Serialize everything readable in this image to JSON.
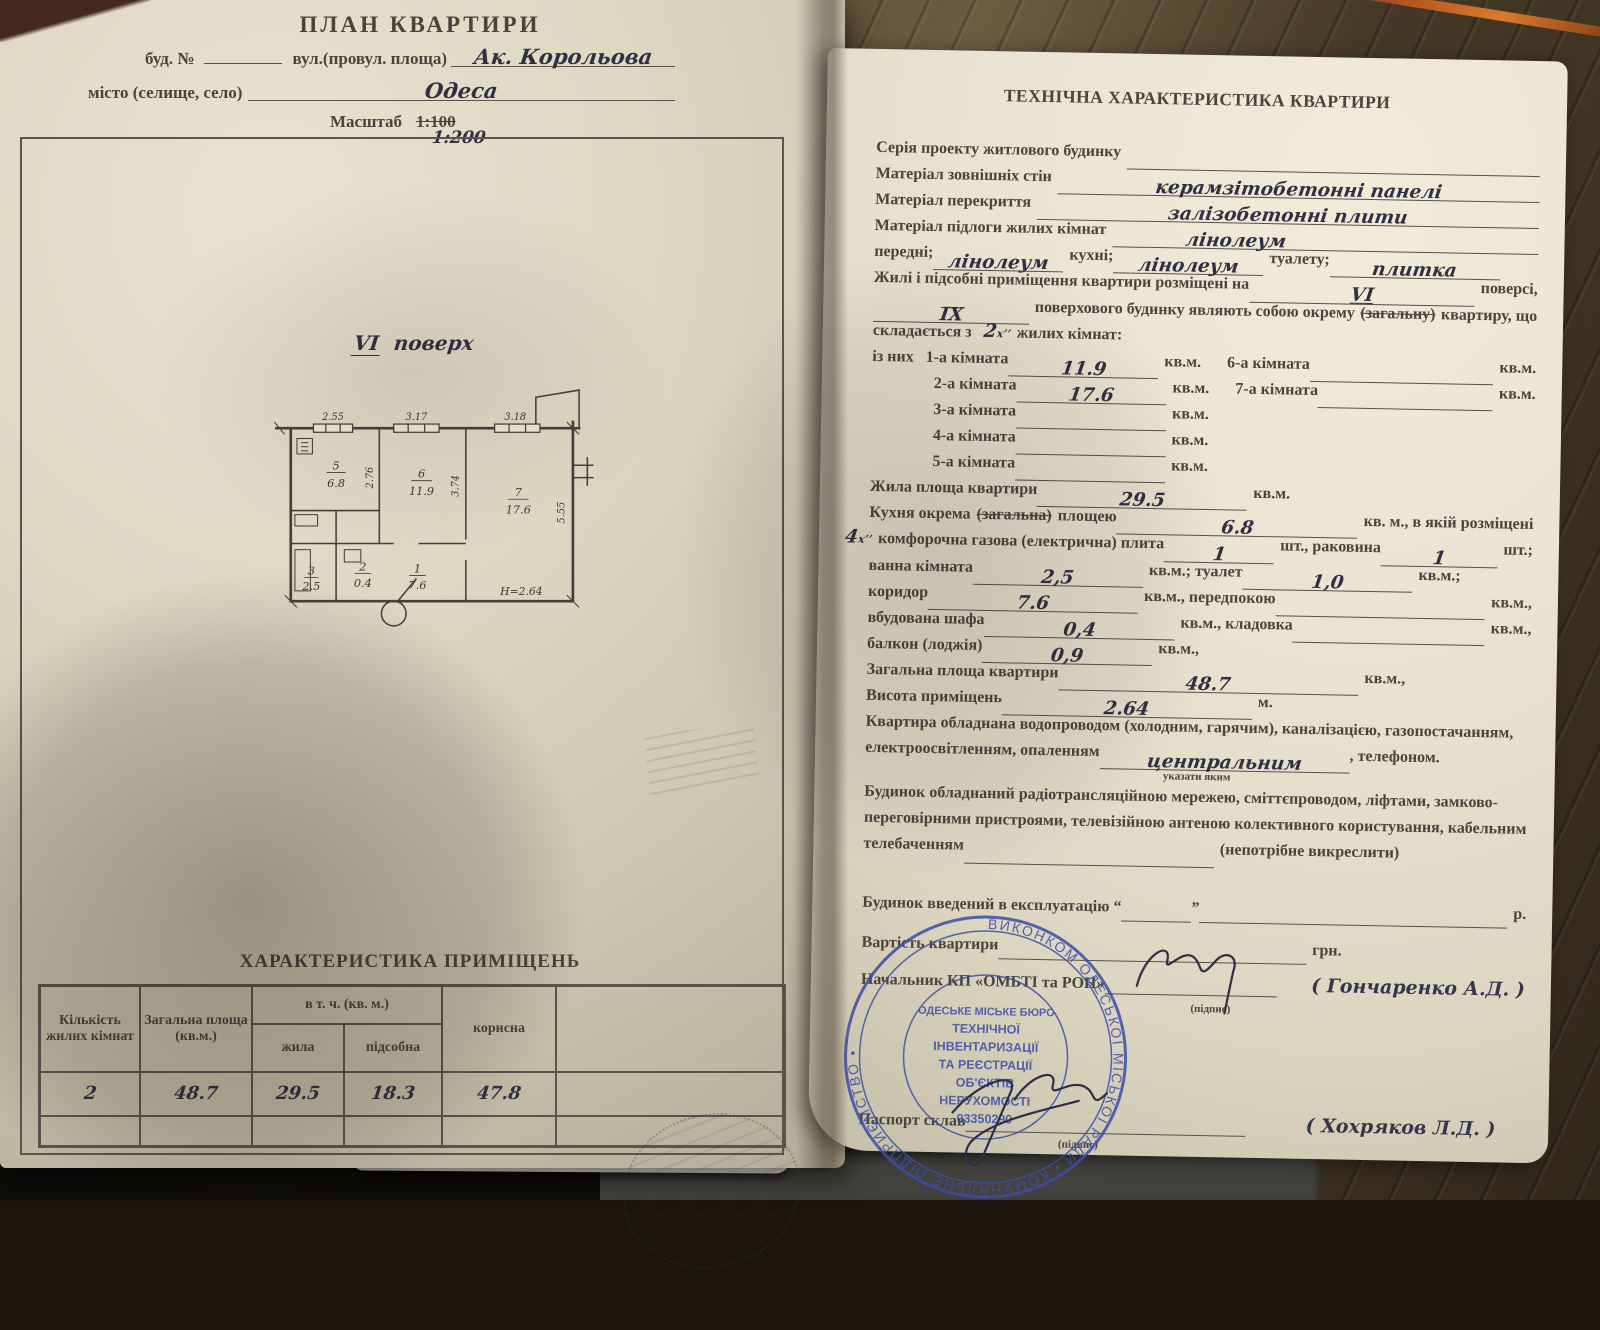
{
  "left": {
    "title": "ПЛАН  КВАРТИРИ",
    "f1a": "буд.  №",
    "f1b": "вул.(провул. площа)",
    "street": "Ак.  Корольова",
    "f2a": "місто (селище, село)",
    "city": "Одеса",
    "f3a": "Масштаб",
    "scale_old": "1:100",
    "scale_new": "1:200",
    "floor_vi": "VI",
    "floor_word": "поверх",
    "plan": {
      "d_top1": "2.55",
      "d_top2": "3.17",
      "d_top3": "3.18",
      "d_k": "2.76",
      "d_6": "3.74",
      "d_7": "5.55",
      "r5n": "5",
      "r5a": "6.8",
      "r6n": "6",
      "r6a": "11.9",
      "r7n": "7",
      "r7a": "17.6",
      "r2n": "2",
      "r2a": "0.4",
      "r1n": "1",
      "r1a": "7.6",
      "r3n": "3",
      "r3a": "2.5",
      "h": "Н=2.64"
    },
    "table": {
      "title": "ХАРАКТЕРИСТИКА ПРИМІЩЕНЬ",
      "h1": "Кількість жилих кімнат",
      "h2": "Загальна площа (кв.м.)",
      "h3": "в т. ч. (кв. м.)",
      "h3a": "жила",
      "h3b": "підсобна",
      "h4": "корисна",
      "row": [
        "2",
        "48.7",
        "29.5",
        "18.3",
        "47.8"
      ]
    }
  },
  "right": {
    "title": "ТЕХНІЧНА ХАРАКТЕРИСТИКА КВАРТИРИ",
    "l01a": "Серія проекту житлового будинку",
    "l02a": "Матеріал зовнішніх стін",
    "l02v": "керамзітобетонні  панелі",
    "l03a": "Матеріал перекриття",
    "l03v": "залізобетонні   плити",
    "l04a": "Матеріал підлоги жилих кімнат",
    "l04v": "лінолеум",
    "l05a": "передні;",
    "l05v1": "лінолеум",
    "l05b": "кухні;",
    "l05v2": "лінолеум",
    "l05c": "туалету;",
    "l05v3": "плитка",
    "l06a": "Жилі і підсобні приміщення квартири розміщені на",
    "l06v": "VI",
    "l06b": "поверсі,",
    "l07v": "ІХ",
    "l07a": "поверхового будинку являють собою окрему",
    "l07s": "(загальну)",
    "l07b": "квартиру, що",
    "l08a": "складається з",
    "l08v": "2",
    "l08sup": "х’’",
    "l08b": "жилих кімнат:",
    "l09a": "із них",
    "l09b": "1-а кімната",
    "l09v": "11.9",
    "l09c": "кв.м.",
    "l09d": "6-а кімната",
    "l09e": "кв.м.",
    "l10a": "2-а кімната",
    "l10v": "17.6",
    "l10b": "кв.м.",
    "l10c": "7-а кімната",
    "l10d": "кв.м.",
    "l11a": "3-а кімната",
    "l11b": "кв.м.",
    "l12a": "4-а кімната",
    "l12b": "кв.м.",
    "l13a": "5-а кімната",
    "l13b": "кв.м.",
    "l14a": "Жила площа квартири",
    "l14v": "29.5",
    "l14b": "кв.м.",
    "l15a": "Кухня окрема",
    "l15s": "(загальна)",
    "l15b": "площею",
    "l15v": "6.8",
    "l15c": "кв. м., в якій розміщені",
    "l16v0": "4",
    "l16sup": "х’’",
    "l16a": "комфорочна  газова  (електрична)  плита",
    "l16v1": "1",
    "l16b": "шт., раковина",
    "l16v2": "1",
    "l16c": "шт.;",
    "l17a": "ванна кімната",
    "l17v": "2,5",
    "l17b": "кв.м.; туалет",
    "l17v2": "1,0",
    "l17c": "кв.м.;",
    "l18a": "коридор",
    "l18v": "7.6",
    "l18b": "кв.м., передпокою",
    "l18c": "кв.м.,",
    "l19a": "вбудована шафа",
    "l19v": "0,4",
    "l19b": "кв.м., кладовка",
    "l19c": "кв.м.,",
    "l20a": "балкон (лоджія)",
    "l20v": "0,9",
    "l20b": "кв.м.,",
    "l21a": "Загальна площа квартири",
    "l21v": "48.7",
    "l21b": "кв.м.,",
    "l22a": "Висота приміщень",
    "l22v": "2.64",
    "l22b": "м.",
    "l23a": "Квартира обладнана водопроводом  (холодним, гарячим),  каналізацією,  газопостачанням,",
    "l24a": "електроосвітленням, опаленням",
    "l24v": "центральним",
    "l24b": ", телефоном.",
    "l25a": "указати яким",
    "l26a": "Будинок  обладнаний   радіотрансляційною  мережею,  сміттєпроводом,  ліфтами,  замково-",
    "l27a": "переговірними пристроями,  телевізійною антеною  колективного  користування,  кабельним",
    "l28a": "телебаченням",
    "l28b": "(непотрібне викреслити)",
    "l29a": "Будинок  введений   в експлуатацію “",
    "l29q": "”",
    "l29b": "р.",
    "l30b": "грн.",
    "l30a": "Вартість квартири",
    "l31a": "Начальник КП «ОМБТІ та РОН»",
    "l31sub": "(підпис)",
    "l31name": "(  Гончаренко  А.Д. )",
    "l32a": "Паспорт склав",
    "l32sub": "(підпис)",
    "l32name": "(  Хохряков  Л.Д. )",
    "stamp": {
      "ring": "ВИКОНКОМ  ОДЕСЬКОЇ  МІСЬКОЇ  РАДИ • КОМУНАЛЬНЕ  ПІДПРИЄМСТВО •",
      "c1": "ОДЕСЬКЕ МІСЬКЕ БЮРО",
      "c2": "ТЕХНІЧНОЇ",
      "c3": "ІНВЕНТАРИЗАЦІЇ",
      "c4": "ТА РЕЄСТРАЦІЇ",
      "c5": "ОБ'ЄКТІВ",
      "c6": "НЕРУХОМОСТІ",
      "c7": "03350290"
    }
  }
}
